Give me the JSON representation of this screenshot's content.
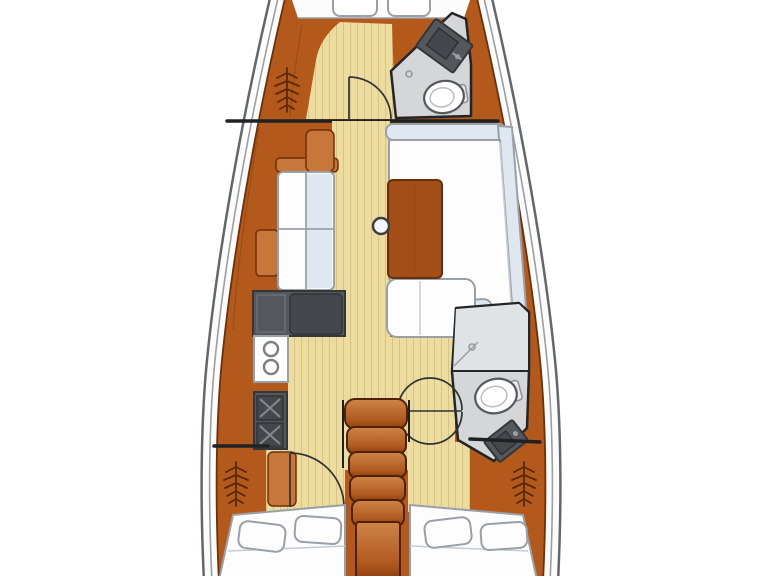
{
  "palette": {
    "bg": "#ffffff",
    "hullLine": "#63676b",
    "deckFill": "#fcfcfd",
    "innerHullLine": "#9b9fa3",
    "wood": "#b2591b",
    "woodLight": "#c8773a",
    "woodDark": "#6e3008",
    "woodSeam": "#8a4412",
    "tableWood": "#a24e16",
    "floor": "#eddc9f",
    "floorLine": "#d9c383",
    "cushion": "#fdfdfe",
    "cushionShade": "#dfe7f1",
    "cushionLine": "#9aa0a8",
    "headFloor": "#d4d6d8",
    "showerFloor": "#e0e3e5",
    "outline": "#232528",
    "counterDark": "#54585c",
    "counterDarker": "#44484c",
    "fixture": "#55585c",
    "burnerLine": "#85898d",
    "stepLight": "#d08448",
    "stepDark": "#8c3c0e",
    "arcLine": "#2f3235",
    "bulkhead": "#1f2124"
  },
  "diagram": {
    "type": "sailing-yacht-interior-floor-plan",
    "view": "top-down",
    "bow": "top",
    "stern": "bottom",
    "rooms": [
      {
        "name": "forward-cabin",
        "position": "bow",
        "features": [
          "berth",
          "two-deck-hatches",
          "hanging-locker",
          "door-swing"
        ]
      },
      {
        "name": "forward-head",
        "position": "bow-starboard",
        "features": [
          "toilet",
          "vanity-sink",
          "shower-drain"
        ]
      },
      {
        "name": "saloon",
        "position": "midship",
        "features": [
          "l-shaped-sofa-starboard",
          "port-settee-4-cushions",
          "wood-table",
          "mast-post",
          "chaise-seat"
        ]
      },
      {
        "name": "galley",
        "position": "midship-port",
        "features": [
          "l-shaped-worktop",
          "double-round-sink",
          "two-x-burners"
        ]
      },
      {
        "name": "companionway",
        "position": "aft-centerline",
        "features": [
          "five-steps",
          "base-landing"
        ]
      },
      {
        "name": "aft-head",
        "position": "aft-starboard",
        "features": [
          "toilet",
          "vanity-sink",
          "shower-drain",
          "door-swing"
        ]
      },
      {
        "name": "aft-cabin-port",
        "position": "stern-port",
        "features": [
          "double-berth",
          "two-pillows",
          "hanging-locker",
          "door-swing"
        ]
      },
      {
        "name": "aft-cabin-starboard",
        "position": "stern-starboard",
        "features": [
          "double-berth",
          "two-pillows",
          "hanging-locker"
        ]
      }
    ]
  }
}
